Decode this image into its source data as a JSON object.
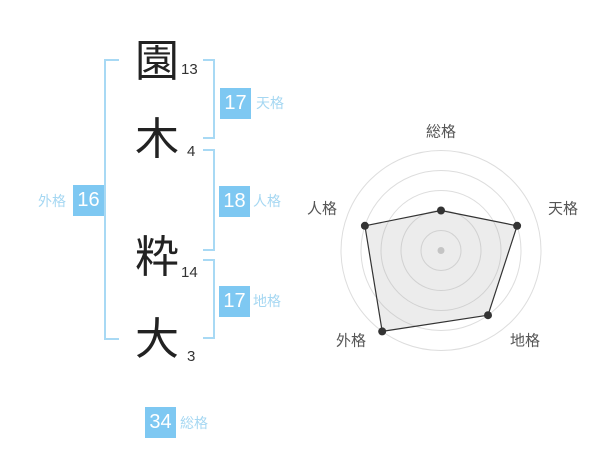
{
  "name_panel": {
    "characters": [
      {
        "char": "園",
        "strokes": 13
      },
      {
        "char": "木",
        "strokes": 4
      },
      {
        "char": "粋",
        "strokes": 14
      },
      {
        "char": "大",
        "strokes": 3
      }
    ],
    "kaku": {
      "tenkaku": {
        "label": "天格",
        "value": 17
      },
      "jinkaku": {
        "label": "人格",
        "value": 18
      },
      "chikaku": {
        "label": "地格",
        "value": 17
      },
      "gaikaku": {
        "label": "外格",
        "value": 16
      },
      "soukaku": {
        "label": "総格",
        "value": 34
      }
    },
    "colors": {
      "value_box_blue": "#7ec8f2",
      "label_blue": "#a5d7f2",
      "bracket_blue": "#a8d9f4",
      "character_text": "#222222",
      "stroke_text": "#333333"
    }
  },
  "chart_data": {
    "type": "radar",
    "categories": [
      "総格",
      "天格",
      "地格",
      "外格",
      "人格"
    ],
    "values": [
      40,
      80,
      80,
      100,
      80
    ],
    "max": 100,
    "rings": 5,
    "grid": "concentric-circles",
    "legend": "none",
    "line_color": "#333333",
    "dot_color": "#333333",
    "fill_color": "rgba(170,170,170,0.22)",
    "grid_color": "#dddddd",
    "center_dot_color": "#cccccc",
    "label_color": "#555555"
  }
}
